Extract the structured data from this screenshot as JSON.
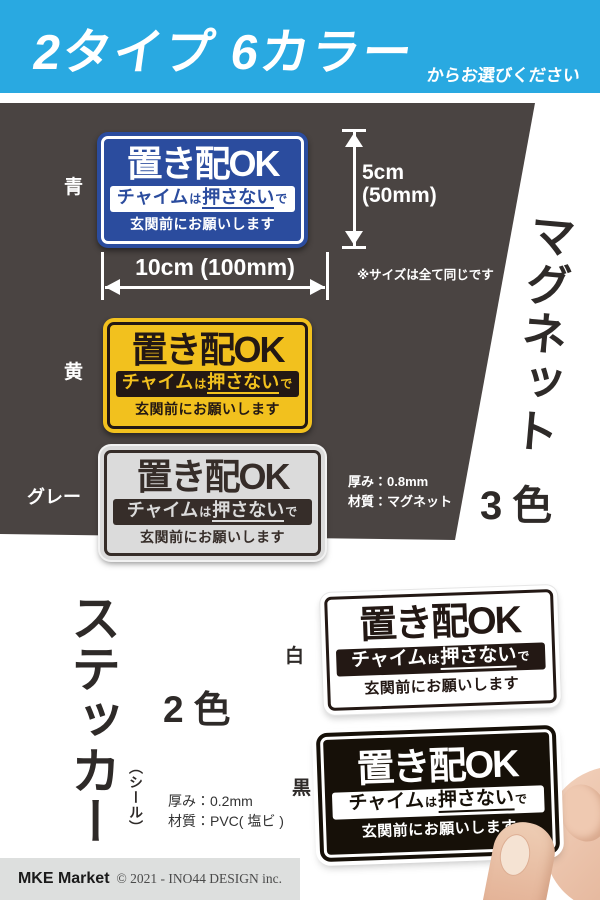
{
  "header": {
    "title": "2タイプ 6カラー",
    "subtitle": "からお選びください"
  },
  "sign_text": {
    "line1": "置き配OK",
    "chime_pre": "チャイム",
    "chime_wa": "は",
    "chime_main": "押さない",
    "chime_de": "で",
    "line3": "玄関前にお願いします"
  },
  "magnet_section": {
    "type_vertical": "マグネット",
    "colors_count": "3色",
    "label_blue": "青",
    "label_yellow": "黄",
    "label_gray": "グレー",
    "height_label_line1": "5cm",
    "height_label_line2": "(50mm)",
    "width_label": "10cm (100mm)",
    "size_note": "※サイズは全て同じです",
    "spec_thickness": "厚み：0.8mm",
    "spec_material": "材質：マグネット"
  },
  "sticker_section": {
    "type_vertical": "ステッカー",
    "type_sub": "（シール）",
    "colors_count": "2色",
    "label_white": "白",
    "label_black": "黒",
    "spec_thickness": "厚み：0.2mm",
    "spec_material": "材質：PVC( 塩ビ )"
  },
  "footer": {
    "brand": "MKE Market",
    "copyright": "© 2021 - INO44 DESIGN inc."
  },
  "colors": {
    "header_blue": "#29A9E1",
    "dark_background": "#4A4442",
    "sign_blue": "#2B4C9E",
    "sign_yellow": "#F2C11E",
    "sign_gray": "#DBDBDB",
    "sign_black": "#161008",
    "dark_text": "#231814",
    "skin": "#EDC7B0",
    "footer_gray": "#DDDFDE"
  }
}
